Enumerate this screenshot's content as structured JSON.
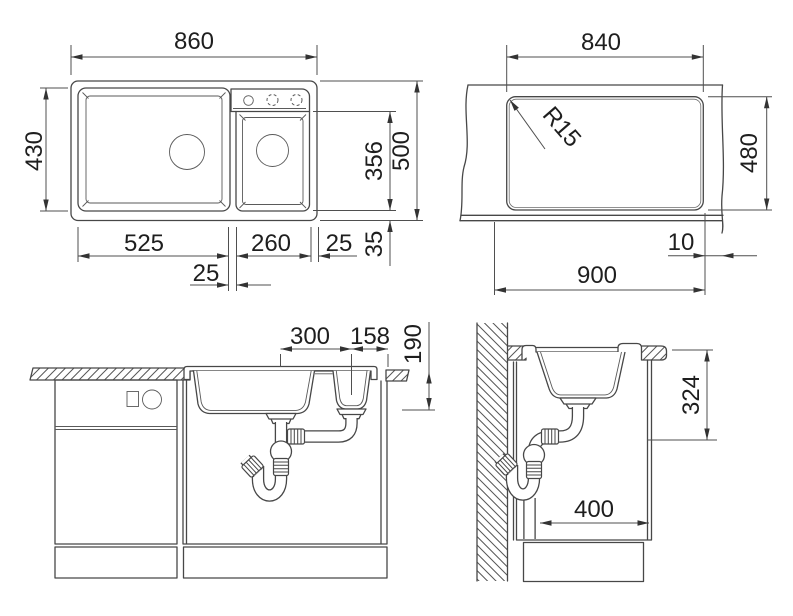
{
  "colors": {
    "background": "#ffffff",
    "line": "#474747",
    "dimension_line": "#4f4f4f",
    "text": "#1e1e1e"
  },
  "views": {
    "top": {
      "dims": {
        "overall_width": "860",
        "main_bowl_depth": "430",
        "main_bowl_width": "525",
        "divider_width": "25",
        "second_bowl_width": "260",
        "right_rim": "25",
        "second_bowl_length": "356",
        "overall_depth": "500",
        "front_rim": "35"
      }
    },
    "cutout": {
      "dims": {
        "cutout_width": "840",
        "corner_radius": "R15",
        "cutout_depth": "480",
        "edge_offset": "10",
        "min_cabinet_width": "900"
      }
    },
    "front": {
      "dims": {
        "drain_spacing": "300",
        "drain_to_edge": "158",
        "bowl_depth": "190"
      }
    },
    "side": {
      "dims": {
        "install_height": "324",
        "drain_clearance": "400"
      }
    }
  }
}
